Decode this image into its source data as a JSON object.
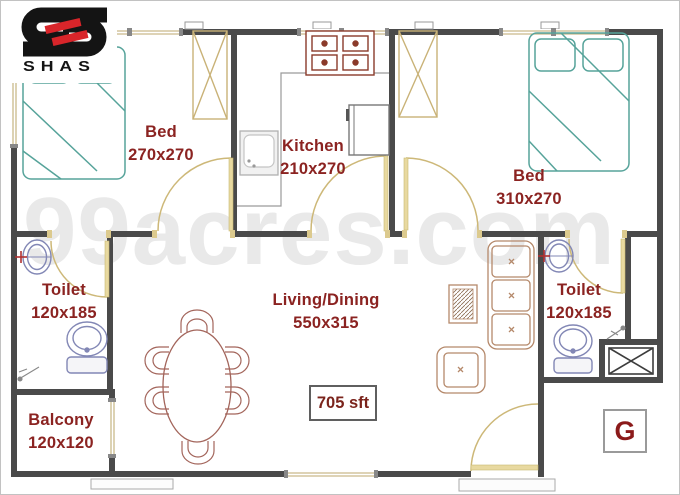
{
  "brand": {
    "name": "SHAS"
  },
  "watermark": "99acres.com",
  "rooms": {
    "bed1": {
      "name": "Bed",
      "dims": "270x270"
    },
    "kitchen": {
      "name": "Kitchen",
      "dims": "210x270"
    },
    "bed2": {
      "name": "Bed",
      "dims": "310x270"
    },
    "toilet_left": {
      "name": "Toilet",
      "dims": "120x185"
    },
    "toilet_right": {
      "name": "Toilet",
      "dims": "120x185"
    },
    "living_dining": {
      "name": "Living/Dining",
      "dims": "550x315"
    },
    "balcony": {
      "name": "Balcony",
      "dims": "120x120"
    }
  },
  "labels": {
    "total_area": "705 sft",
    "floor_marker": "G"
  },
  "colors": {
    "wall": "#4a4a4a",
    "room_text": "#8b2321",
    "bed_outline": "#56a39a",
    "door": "#cdb878",
    "wardrobe": "#c9b277",
    "dining": "#a3655b",
    "sofa": "#b5896b",
    "sanitary": "#8287b5",
    "stove": "#8a3a2a",
    "logo_red": "#d8252a",
    "watermark_gray": "#e9e9e9"
  }
}
